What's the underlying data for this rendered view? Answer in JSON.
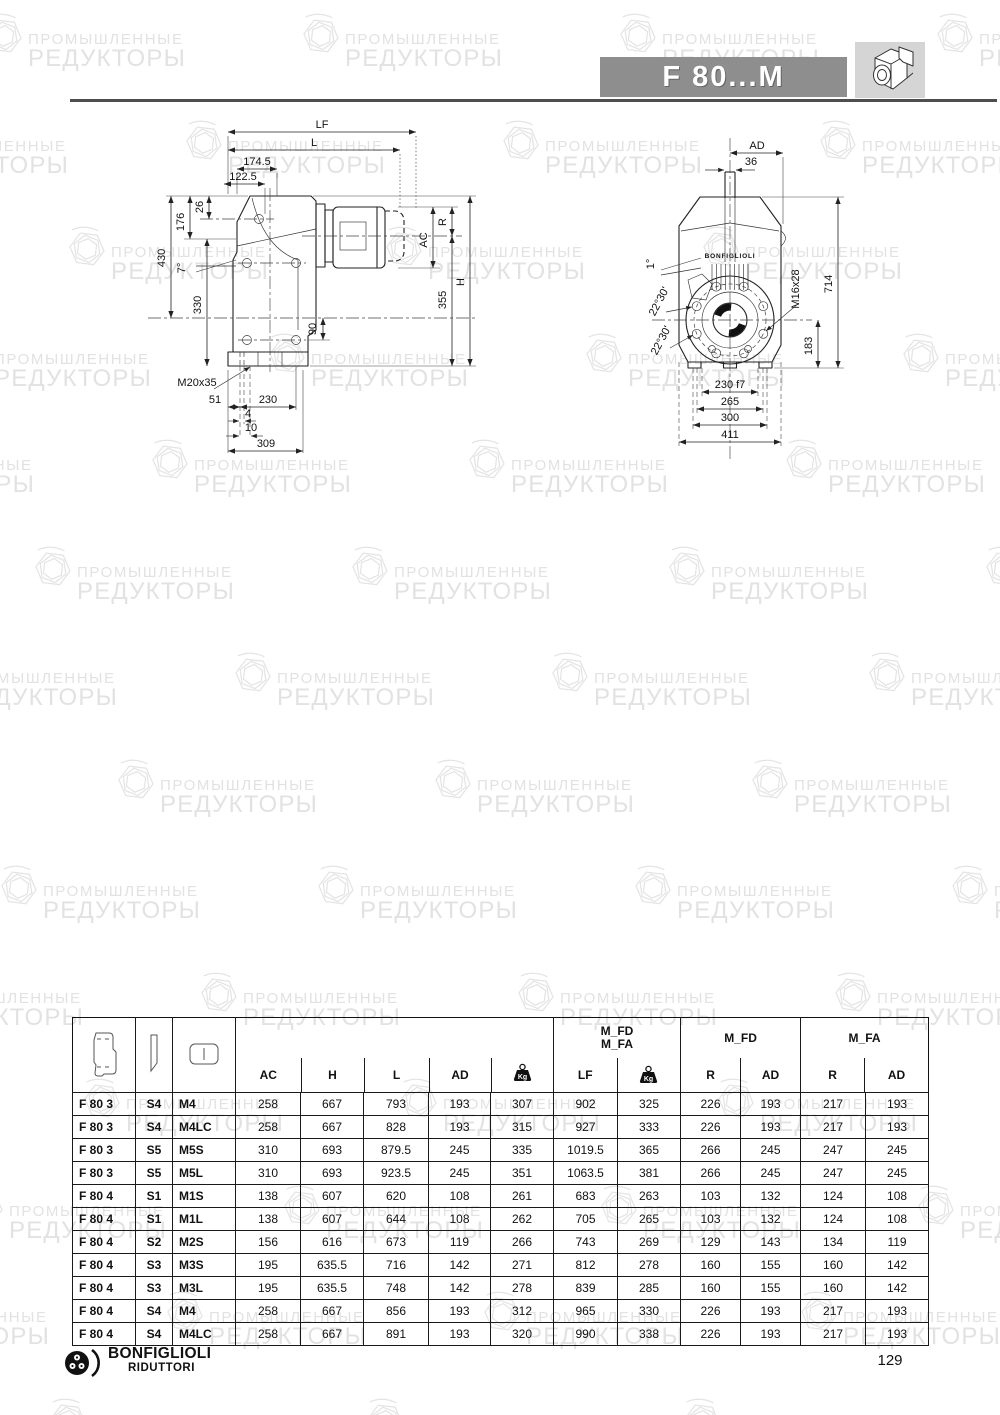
{
  "watermark": {
    "line1": "ПРОМЫШЛЕННЫЕ",
    "line2": "РЕДУКТОРЫ"
  },
  "header": {
    "title": "F 80...M"
  },
  "footer": {
    "brand_top": "BONFIGLIOLI",
    "brand_bottom": "RIDUTTORI",
    "page_number": "129"
  },
  "drawing_side": {
    "dims": {
      "lf": "LF",
      "l": "L",
      "d174": "174.5",
      "d122": "122.5",
      "d26": "26",
      "d176": "176",
      "d430": "430",
      "d330": "330",
      "a7": "7°",
      "d90": "90",
      "r": "R",
      "ac": "AC",
      "d355": "355",
      "h": "H",
      "m20": "M20x35",
      "d51": "51",
      "d230": "230",
      "d4": "4",
      "d10": "10",
      "d309": "309"
    }
  },
  "drawing_front": {
    "brand": "BONFIGLIOLI",
    "dims": {
      "ad": "AD",
      "d36": "36",
      "a1": "1°",
      "a2230": "22°30'",
      "m16": "M16x28",
      "d714": "714",
      "d183": "183",
      "d230f7": "230 f7",
      "d265": "265",
      "d300": "300",
      "d411": "411"
    }
  },
  "table": {
    "kg_label": "Kg",
    "groups": {
      "combo_line1": "M_FD",
      "combo_line2": "M_FA",
      "mfd": "M_FD",
      "mfa": "M_FA"
    },
    "col_headers": {
      "ac": "AC",
      "h": "H",
      "l": "L",
      "ad": "AD",
      "lf": "LF",
      "r1": "R",
      "ad1": "AD",
      "r2": "R",
      "ad2": "AD"
    },
    "rows": [
      [
        "F 80 3",
        "S4",
        "M4",
        "258",
        "667",
        "793",
        "193",
        "307",
        "902",
        "325",
        "226",
        "193",
        "217",
        "193"
      ],
      [
        "F 80 3",
        "S4",
        "M4LC",
        "258",
        "667",
        "828",
        "193",
        "315",
        "927",
        "333",
        "226",
        "193",
        "217",
        "193"
      ],
      [
        "F 80 3",
        "S5",
        "M5S",
        "310",
        "693",
        "879.5",
        "245",
        "335",
        "1019.5",
        "365",
        "266",
        "245",
        "247",
        "245"
      ],
      [
        "F 80 3",
        "S5",
        "M5L",
        "310",
        "693",
        "923.5",
        "245",
        "351",
        "1063.5",
        "381",
        "266",
        "245",
        "247",
        "245"
      ],
      [
        "F 80 4",
        "S1",
        "M1S",
        "138",
        "607",
        "620",
        "108",
        "261",
        "683",
        "263",
        "103",
        "132",
        "124",
        "108"
      ],
      [
        "F 80 4",
        "S1",
        "M1L",
        "138",
        "607",
        "644",
        "108",
        "262",
        "705",
        "265",
        "103",
        "132",
        "124",
        "108"
      ],
      [
        "F 80 4",
        "S2",
        "M2S",
        "156",
        "616",
        "673",
        "119",
        "266",
        "743",
        "269",
        "129",
        "143",
        "134",
        "119"
      ],
      [
        "F 80 4",
        "S3",
        "M3S",
        "195",
        "635.5",
        "716",
        "142",
        "271",
        "812",
        "278",
        "160",
        "155",
        "160",
        "142"
      ],
      [
        "F 80 4",
        "S3",
        "M3L",
        "195",
        "635.5",
        "748",
        "142",
        "278",
        "839",
        "285",
        "160",
        "155",
        "160",
        "142"
      ],
      [
        "F 80 4",
        "S4",
        "M4",
        "258",
        "667",
        "856",
        "193",
        "312",
        "965",
        "330",
        "226",
        "193",
        "217",
        "193"
      ],
      [
        "F 80 4",
        "S4",
        "M4LC",
        "258",
        "667",
        "891",
        "193",
        "320",
        "990",
        "338",
        "226",
        "193",
        "217",
        "193"
      ]
    ]
  }
}
